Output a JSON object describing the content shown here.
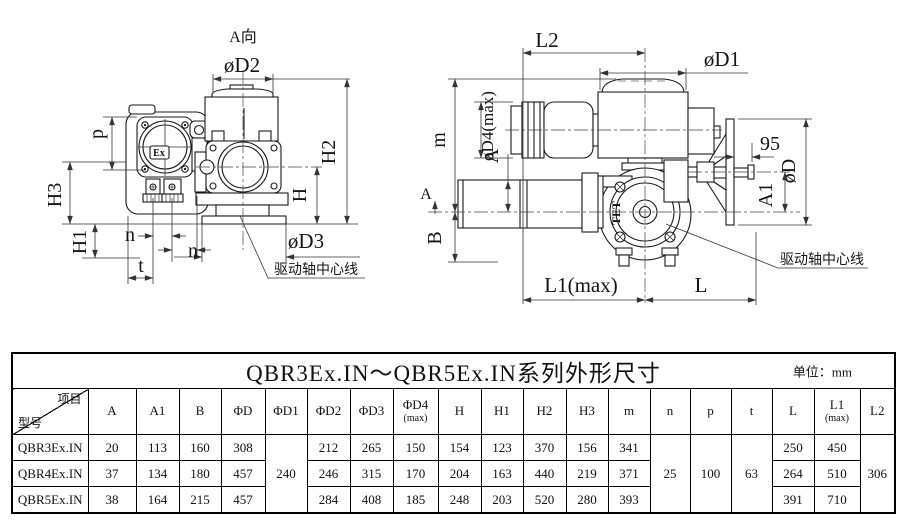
{
  "drawings": {
    "left": {
      "view_label": "A向",
      "ex_logo": "Ex",
      "shaft_centerline_note": "驱动轴中心线",
      "labels": {
        "phiD2": "øD2",
        "H2": "H2",
        "H": "H",
        "phiD3": "øD3",
        "p": "p",
        "H3": "H3",
        "H1": "H1",
        "n1": "n",
        "n2": "n",
        "t": "t"
      }
    },
    "right": {
      "view_arrow_label": "A",
      "cover_logo": "TET",
      "shaft_centerline_note": "驱动轴中心线",
      "labels": {
        "L2": "L2",
        "phiD1": "øD1",
        "phiD4": "øD4(max)",
        "m": "m",
        "A": "A",
        "B": "B",
        "dim95": "95",
        "phiD": "øD",
        "A1": "A1",
        "L1": "L1(max)",
        "L": "L"
      }
    }
  },
  "table": {
    "title": "QBR3Ex.IN～QBR5Ex.IN系列外形尺寸",
    "unit_label": "单位：mm",
    "corner": {
      "top_right": "项目",
      "bottom_left": "型号"
    },
    "columns": [
      [
        "A"
      ],
      [
        "A1"
      ],
      [
        "B"
      ],
      [
        "ΦD"
      ],
      [
        "ΦD1"
      ],
      [
        "ΦD2"
      ],
      [
        "ΦD3"
      ],
      [
        "ΦD4",
        "(max)"
      ],
      [
        "H"
      ],
      [
        "H1"
      ],
      [
        "H2"
      ],
      [
        "H3"
      ],
      [
        "m"
      ],
      [
        "n"
      ],
      [
        "p"
      ],
      [
        "t"
      ],
      [
        "L"
      ],
      [
        "L1",
        "(max)"
      ],
      [
        "L2"
      ]
    ],
    "rows": [
      {
        "model": "QBR3Ex.IN",
        "values": [
          "20",
          "113",
          "160",
          "308",
          [
            "240",
            3
          ],
          "212",
          "265",
          "150",
          "154",
          "123",
          "370",
          "156",
          "341",
          [
            "25",
            3
          ],
          [
            "100",
            3
          ],
          [
            "63",
            3
          ],
          "250",
          "450",
          [
            "306",
            3
          ]
        ]
      },
      {
        "model": "QBR4Ex.IN",
        "values": [
          "37",
          "134",
          "180",
          "457",
          null,
          "246",
          "315",
          "170",
          "204",
          "163",
          "440",
          "219",
          "371",
          null,
          null,
          null,
          "264",
          "510",
          null
        ]
      },
      {
        "model": "QBR5Ex.IN",
        "values": [
          "38",
          "164",
          "215",
          "457",
          null,
          "284",
          "408",
          "185",
          "248",
          "203",
          "520",
          "280",
          "393",
          null,
          null,
          null,
          "391",
          "710",
          null
        ]
      }
    ]
  }
}
